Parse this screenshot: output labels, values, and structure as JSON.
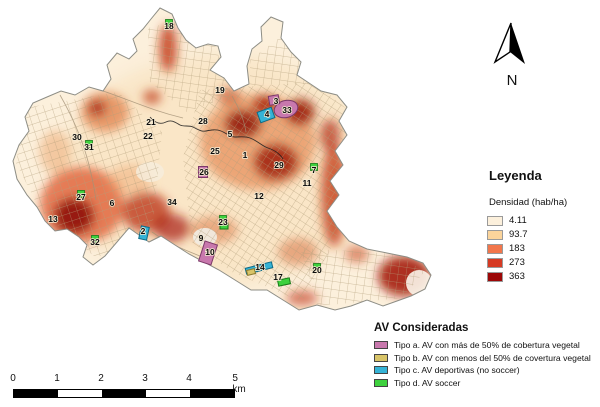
{
  "north_arrow": {
    "label": "N"
  },
  "legend": {
    "title": "Leyenda",
    "subtitle": "Densidad (hab/ha)",
    "classes": [
      {
        "value": "4.11",
        "color": "#fcf0dc"
      },
      {
        "value": "93.7",
        "color": "#fbd49b"
      },
      {
        "value": "183",
        "color": "#f2764b"
      },
      {
        "value": "273",
        "color": "#d63a23"
      },
      {
        "value": "363",
        "color": "#9c0707"
      }
    ]
  },
  "av_legend": {
    "title": "AV Consideradas",
    "items": [
      {
        "label": "Tipo a. AV con más de 50% de cobertura vegetal",
        "color": "#c878ad"
      },
      {
        "label": "Tipo b. AV con menos del 50% de covertura vegetal",
        "color": "#d8c468"
      },
      {
        "label": "Tipo c. AV deportivas (no soccer)",
        "color": "#35b3d6"
      },
      {
        "label": "Tipo d. AV soccer",
        "color": "#3ed13e"
      }
    ]
  },
  "scale_bar": {
    "labels": [
      "0",
      "1",
      "2",
      "3",
      "4",
      "5 km"
    ],
    "segments": [
      "black",
      "white",
      "black",
      "white",
      "black"
    ]
  },
  "map": {
    "colors": {
      "pink": "#c878ad",
      "pinkBorder": "#7c3a69",
      "cyan": "#35b3d6",
      "cyanBorder": "#0f6a85",
      "green": "#3ed13e",
      "greenBorder": "#187a18",
      "tan": "#d8c468",
      "tanBorder": "#8a7a2e"
    },
    "av_shapes": [
      {
        "type": "pink",
        "shape": "ellipse",
        "x": 286,
        "y": 109,
        "w": 24,
        "h": 17,
        "rot": -15
      },
      {
        "type": "pink",
        "shape": "rect",
        "x": 274,
        "y": 100,
        "w": 10,
        "h": 9,
        "rot": -10
      },
      {
        "type": "cyan",
        "shape": "rect",
        "x": 266,
        "y": 115,
        "w": 15,
        "h": 11,
        "rot": -20
      },
      {
        "type": "pink",
        "shape": "rect",
        "x": 208,
        "y": 253,
        "w": 13,
        "h": 21,
        "rot": 18
      },
      {
        "type": "pink",
        "shape": "rect",
        "x": 203,
        "y": 172,
        "w": 9,
        "h": 11,
        "rot": 0
      },
      {
        "type": "cyan",
        "shape": "rect",
        "x": 259,
        "y": 268,
        "w": 27,
        "h": 6,
        "rot": -14
      },
      {
        "type": "cyan",
        "shape": "rect",
        "x": 144,
        "y": 233,
        "w": 8,
        "h": 13,
        "rot": 12
      },
      {
        "type": "green",
        "shape": "rect",
        "x": 284,
        "y": 282,
        "w": 12,
        "h": 6,
        "rot": -12
      },
      {
        "type": "green",
        "shape": "rect",
        "x": 224,
        "y": 226,
        "w": 8,
        "h": 6,
        "rot": 0
      },
      {
        "type": "tan",
        "shape": "rect",
        "x": 251,
        "y": 272,
        "w": 8,
        "h": 5,
        "rot": -14
      }
    ],
    "points": [
      {
        "n": "1",
        "x": 245,
        "y": 155
      },
      {
        "n": "2",
        "x": 143,
        "y": 231
      },
      {
        "n": "3",
        "x": 276,
        "y": 101
      },
      {
        "n": "4",
        "x": 267,
        "y": 114
      },
      {
        "n": "5",
        "x": 230,
        "y": 134
      },
      {
        "n": "6",
        "x": 112,
        "y": 203
      },
      {
        "n": "7",
        "x": 314,
        "y": 170,
        "marker": "green"
      },
      {
        "n": "9",
        "x": 201,
        "y": 238
      },
      {
        "n": "10",
        "x": 210,
        "y": 252
      },
      {
        "n": "11",
        "x": 307,
        "y": 183
      },
      {
        "n": "12",
        "x": 259,
        "y": 196
      },
      {
        "n": "13",
        "x": 53,
        "y": 219
      },
      {
        "n": "14",
        "x": 260,
        "y": 267
      },
      {
        "n": "17",
        "x": 278,
        "y": 277
      },
      {
        "n": "18",
        "x": 169,
        "y": 26,
        "marker": "green"
      },
      {
        "n": "19",
        "x": 220,
        "y": 90
      },
      {
        "n": "20",
        "x": 317,
        "y": 270,
        "marker": "green"
      },
      {
        "n": "21",
        "x": 151,
        "y": 122
      },
      {
        "n": "22",
        "x": 148,
        "y": 136
      },
      {
        "n": "23",
        "x": 223,
        "y": 222,
        "marker": "green"
      },
      {
        "n": "25",
        "x": 215,
        "y": 151
      },
      {
        "n": "26",
        "x": 204,
        "y": 172
      },
      {
        "n": "27",
        "x": 81,
        "y": 197,
        "marker": "green"
      },
      {
        "n": "28",
        "x": 203,
        "y": 121
      },
      {
        "n": "29",
        "x": 279,
        "y": 165
      },
      {
        "n": "30",
        "x": 77,
        "y": 137
      },
      {
        "n": "31",
        "x": 89,
        "y": 147,
        "marker": "green"
      },
      {
        "n": "32",
        "x": 95,
        "y": 242,
        "marker": "green"
      },
      {
        "n": "33",
        "x": 287,
        "y": 110
      },
      {
        "n": "34",
        "x": 172,
        "y": 202
      }
    ]
  }
}
